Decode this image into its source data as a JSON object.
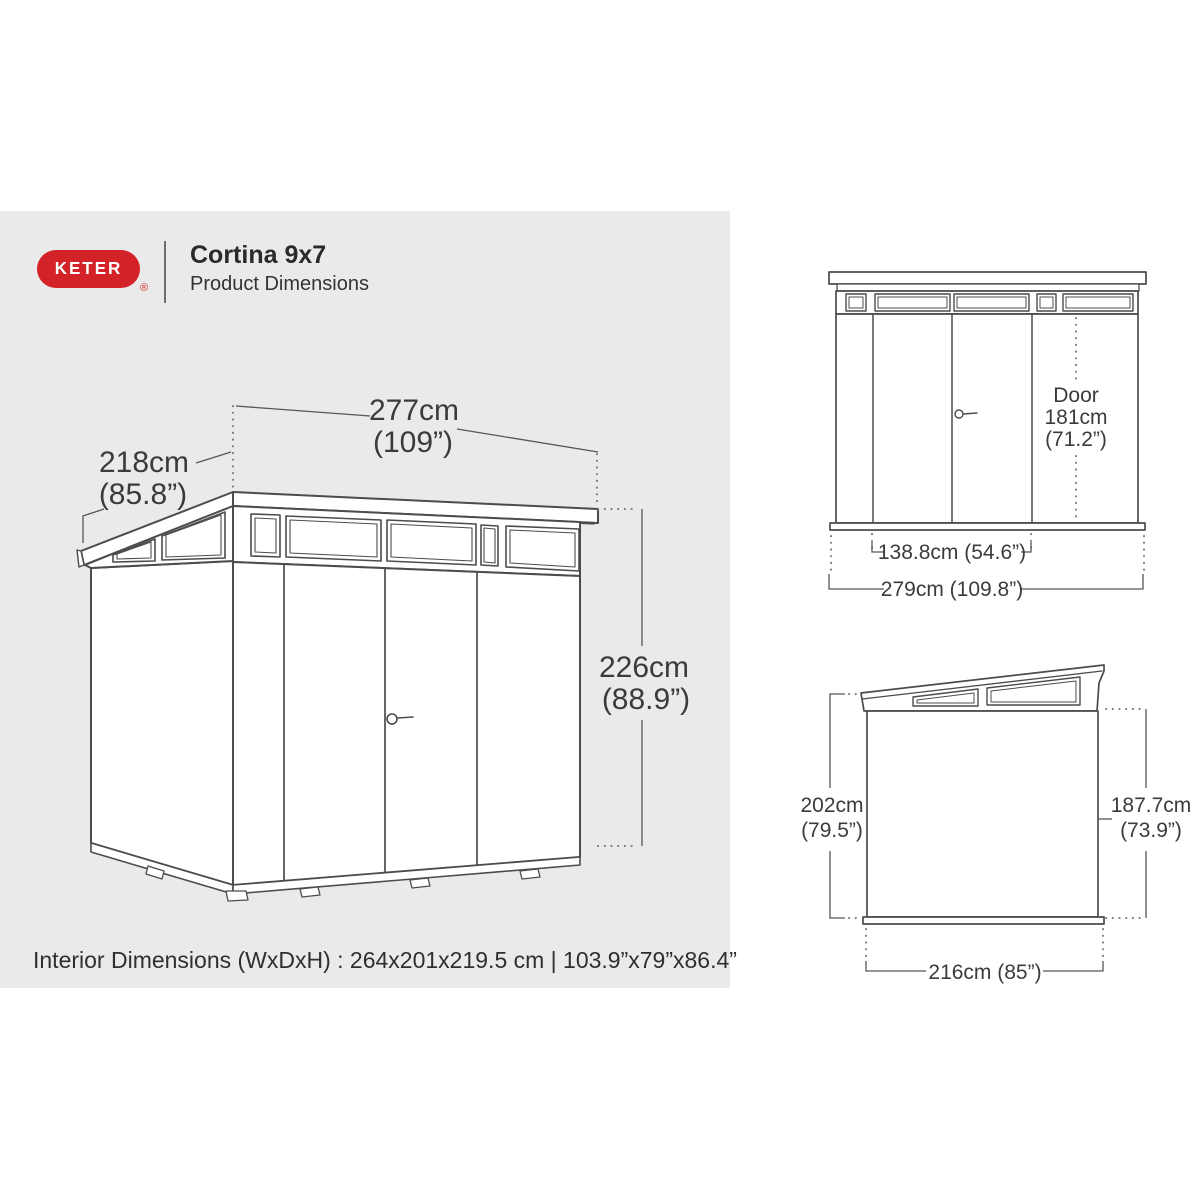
{
  "header": {
    "brand": "KETER",
    "registered": "®",
    "title": "Cortina 9x7",
    "subtitle": "Product Dimensions"
  },
  "main_drawing": {
    "width_cm": "277cm",
    "width_in": "(109”)",
    "depth_cm": "218cm",
    "depth_in": "(85.8”)",
    "height_cm": "226cm",
    "height_in": "(88.9”)"
  },
  "front_view": {
    "door_line1": "Door",
    "door_line2": "181cm",
    "door_line3": "(71.2”)",
    "inner_width": "138.8cm (54.6”)",
    "total_width": "279cm (109.8”)"
  },
  "side_view": {
    "back_height_cm": "202cm",
    "back_height_in": "(79.5”)",
    "front_height_cm": "187.7cm",
    "front_height_in": "(73.9”)",
    "width": "216cm (85”)"
  },
  "footer": {
    "interior_dimensions": "Interior Dimensions (WxDxH) : 264x201x219.5 cm | 103.9”x79”x86.4”"
  },
  "colors": {
    "brand_red": "#d42328",
    "line": "#4b4c4f",
    "dimension_line": "#55565a",
    "text": "#3b3b3d",
    "panel_bg": "#eaeaea"
  }
}
